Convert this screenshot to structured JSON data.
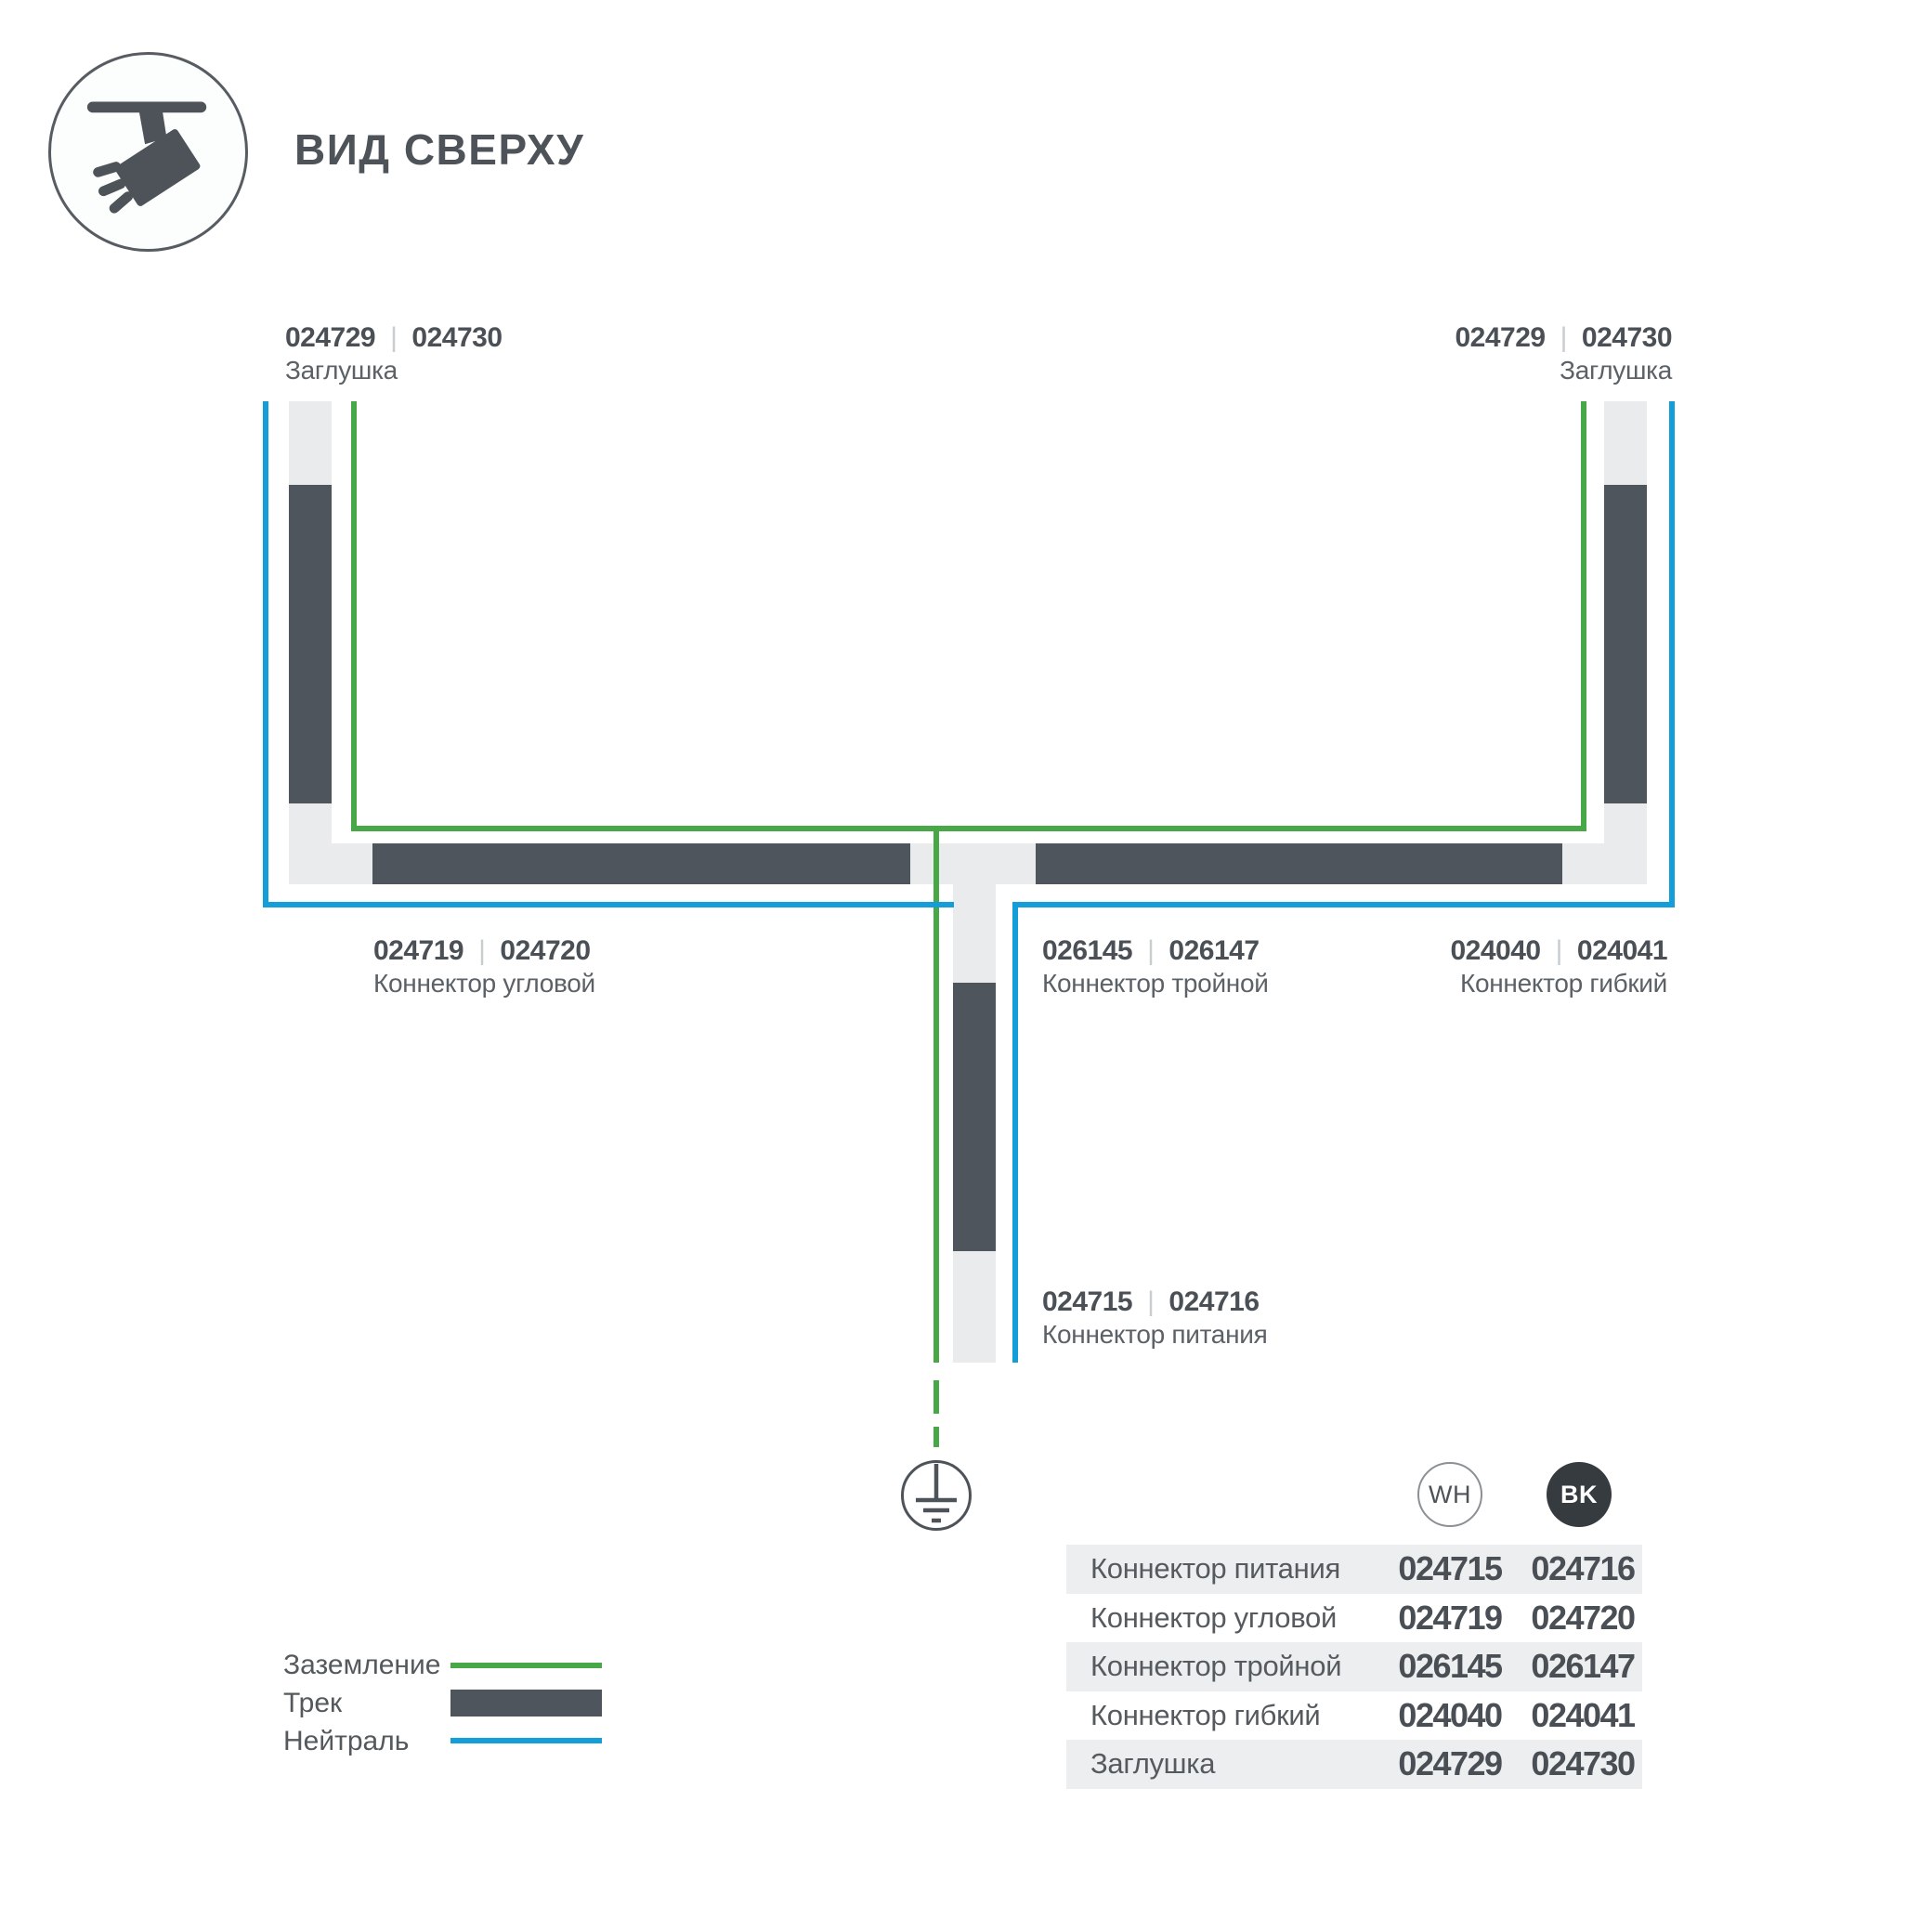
{
  "header": {
    "title": "ВИД СВЕРХУ"
  },
  "diagram": {
    "divider": "|",
    "cap_left": {
      "code_wh": "024729",
      "code_bk": "024730",
      "name": "Заглушка"
    },
    "cap_right": {
      "code_wh": "024729",
      "code_bk": "024730",
      "name": "Заглушка"
    },
    "corner": {
      "code_wh": "024719",
      "code_bk": "024720",
      "name": "Коннектор угловой"
    },
    "triple": {
      "code_wh": "026145",
      "code_bk": "026147",
      "name": "Коннектор тройной"
    },
    "flex": {
      "code_wh": "024040",
      "code_bk": "024041",
      "name": "Коннектор гибкий"
    },
    "power": {
      "code_wh": "024715",
      "code_bk": "024716",
      "name": "Коннектор питания"
    }
  },
  "legend": {
    "ground": {
      "label": "Заземление"
    },
    "track": {
      "label": "Трек"
    },
    "neutral": {
      "label": "Нейтраль"
    }
  },
  "table": {
    "columns": {
      "wh": "WH",
      "bk": "BK"
    },
    "rows": [
      {
        "name": "Коннектор питания",
        "wh": "024715",
        "bk": "024716"
      },
      {
        "name": "Коннектор угловой",
        "wh": "024719",
        "bk": "024720"
      },
      {
        "name": "Коннектор тройной",
        "wh": "026145",
        "bk": "026147"
      },
      {
        "name": "Коннектор гибкий",
        "wh": "024040",
        "bk": "024041"
      },
      {
        "name": "Заглушка",
        "wh": "024729",
        "bk": "024730"
      }
    ]
  },
  "colors": {
    "track": "#4e555c",
    "connector": "#e9ebec",
    "ground_line": "#48a747",
    "neutral_line": "#149ed9",
    "text": "#4d5358",
    "row_shade": "#eceeef",
    "bk_badge": "#363b40"
  }
}
